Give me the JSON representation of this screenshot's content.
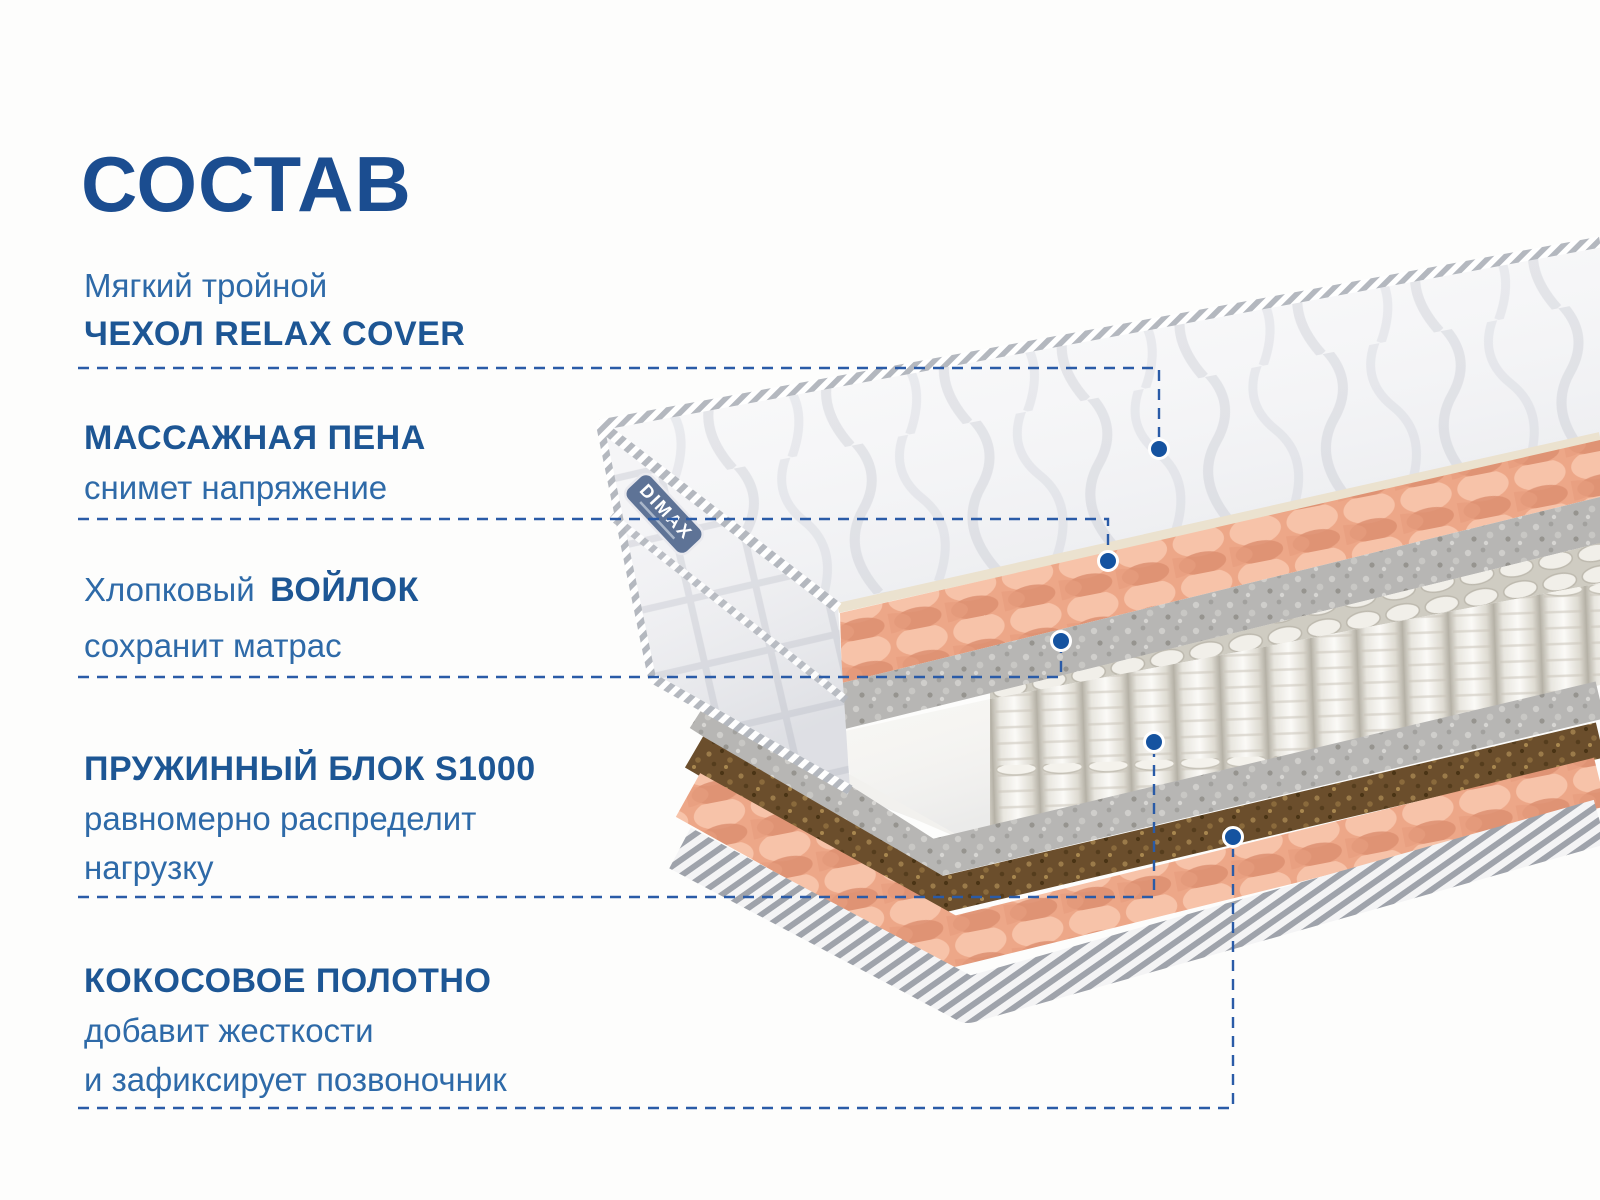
{
  "title": "СОСТАВ",
  "annotations": {
    "cover": {
      "regular": "Мягкий тройной",
      "bold": "ЧЕХОЛ RELAX COVER"
    },
    "foam": {
      "bold": "МАССАЖНАЯ ПЕНА",
      "regular": "снимет напряжение"
    },
    "felt": {
      "regular_prefix": "Хлопковый",
      "bold": "ВОЙЛОК",
      "regular": "сохранит матрас"
    },
    "springs": {
      "bold": "ПРУЖИННЫЙ БЛОК S1000",
      "regular1": "равномерно распределит",
      "regular2": "нагрузку"
    },
    "coconut": {
      "bold": "КОКОСОВОЕ ПОЛОТНО",
      "regular1": "добавит жесткости",
      "regular2": "и зафиксирует позвоночник"
    }
  },
  "brand_label": "DIMAX",
  "colors": {
    "title": "#1b4d90",
    "heading": "#1d5694",
    "body_text": "#2e6aa8",
    "connector": "#2a5ba7",
    "dot": "#1553a0",
    "peach_layer": "#f1b294",
    "felt_layer": "#b7b6b4",
    "coconut_layer": "#6b4e2c",
    "spring_layer": "#f0eee8",
    "brand_tag": "#5e7396"
  }
}
